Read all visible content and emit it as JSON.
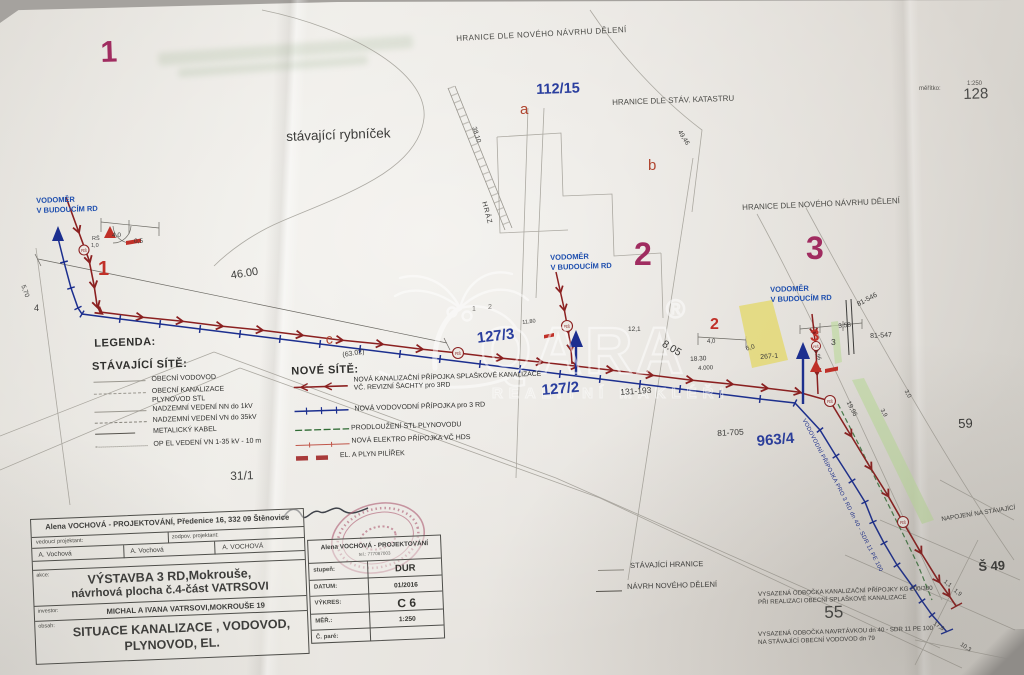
{
  "watermark": {
    "brand": "QARA",
    "reg": "®",
    "subtitle": "REALITNÍ MAKLÉŘI"
  },
  "scalebar": {
    "label": "měřítko:",
    "value": "1:250"
  },
  "boundaries": {
    "new_top": "HRANICE DLE NOVÉHO NÁVRHU DĚLENÍ",
    "cadastre": "HRANICE DLE STÁV. KATASTRU",
    "new_right": "HRANICE DLE NOVÉHO NÁVRHU DĚLENÍ"
  },
  "features": {
    "pond": "stávající rybníček",
    "dam": "HRÁZ",
    "connect": "NAPOJENÍ NA STÁVAJÍCÍ"
  },
  "areas": {
    "n1": "1",
    "n2": "2",
    "n3": "3",
    "r1": "1",
    "r2": "2",
    "r3": "3",
    "a": "a",
    "b": "b",
    "c": "c",
    "lot1": "1",
    "lot2": "2"
  },
  "parcels": {
    "p11215": "112/15",
    "p1273": "127/3",
    "p1272": "127/2",
    "p9634": "963/4",
    "p311": "31/1",
    "p128": "128",
    "p59": "59",
    "p55": "55",
    "p131": "131-193",
    "p81705": "81-705",
    "p81546": "81-546",
    "p81547": "81-547",
    "p2671": "267-1",
    "s49": "Š 49",
    "p3": "3"
  },
  "water_meter": {
    "l1": "VODOMĚR",
    "l2": "V BUDOUCÍM RD"
  },
  "symbols": {
    "rs": "RŠ",
    "rs_val": "1,0"
  },
  "dims": {
    "d46": "46.00",
    "d6302": "(63.02)",
    "d570": "5,70",
    "d4": "4",
    "d40": "4,0",
    "d05": "0,5",
    "d3810": "38,10",
    "d4946": "49,46",
    "d1180": "11,80",
    "d121": "12,1",
    "d805": "8.05",
    "d1830": "18.30",
    "d4000": "4.000",
    "d40b": "4,0",
    "d358": "3,58",
    "d60": "6,0",
    "d196": "1,96",
    "d1996": "19,96",
    "d30": "3,0",
    "d39": "3,9",
    "d11": "1,1",
    "d19": "1,9",
    "d178": "17,8",
    "d103": "10,3"
  },
  "pipes": {
    "water_branch": "VODOVODNÍ PŘÍPOJKA PRO 3 RD dn 40 - SDR 11 PE 100"
  },
  "legend": {
    "title": "LEGENDA:",
    "existing_title": "STÁVAJÍCÍ SÍTĚ:",
    "existing": [
      "OBECNÍ VODOVOD",
      "OBECNÍ KANALIZACE",
      "PLYNOVOD STL",
      "NADZEMNÍ VEDENÍ  NN do 1kV",
      "NADZEMNÍ VEDENÍ  VN do 35kV",
      "METALICKÝ KABEL",
      "OP EL VEDENÍ VN 1-35 kV  - 10 m"
    ],
    "new_title": "NOVÉ SÍTĚ:",
    "new_1a": "NOVÁ KANALIZAČNÍ PŘÍPOJKA SPLAŠKOVÉ KANALIZACE",
    "new_1b": "VČ. REVIZNÍ  ŠACHTY  pro 3RD",
    "new_2": "NOVÁ VODOVODNÍ  PŘÍPOJKA  pro 3 RD",
    "new_3": "PRODLOUŽENÍ  STL  PLYNOVODU",
    "new_4": "NOVÁ ELEKTRO  PŘÍPOJKA VČ HDS",
    "new_5": "EL. A PLYN PILÍŘEK"
  },
  "mini_legend": {
    "existing": "STÁVAJÍCÍ  HRANICE",
    "new": "NÁVRH NOVÉHO DĚLENÍ"
  },
  "notes": {
    "sewer1": "VYSAZENÁ ODBOČKA  KANALIZAČNÍ PŘÍPOJKY  KG 200/300",
    "sewer2": "PŘI REALIZACI OBECNÍ SPLAŠKOVÉ KANALIZACE",
    "water1": "VYSAZENÁ ODBOČKA  NAVRTÁVKOU dn 40  - SDR 11 PE 100",
    "water2": "NA STÁVAJÍCÍ OBECNÍ VODOVOD  dn 79"
  },
  "title_block": {
    "company": "Alena VOCHOVÁ - PROJEKTOVÁNÍ, Předenice 16, 332 09 Štěnovice",
    "lead_label": "vedoucí projektant:",
    "resp_label": "zodpov. projektant:",
    "name1": "A. Vochová",
    "name2": "A. Vochová",
    "name3": "A. VOCHOVÁ",
    "akce_label": "akce:",
    "akce1": "VÝSTAVBA 3 RD,Mokrouše,",
    "akce2": "návrhová plocha č.4-část VATRSOVI",
    "investor_label": "investor:",
    "investor": "MICHAL A IVANA VATRSOVI,MOKROUŠE 19",
    "obsah_label": "obsah:",
    "obsah1": "SITUACE  KANALIZACE , VODOVOD,",
    "obsah2": "PLYNOVOD, EL.",
    "company_short": "Alena VOCHOVÁ - PROJEKTOVÁNÍ",
    "phone": "tel.: 777087003",
    "stupen_label": "stupeň:",
    "stupen": "DUR",
    "datum_label": "DATUM:",
    "datum": "01/2016",
    "vykres_label": "VÝKRES:",
    "vykres": "C 6",
    "mer_label": "MĚŘ.:",
    "mer": "1:250",
    "pare_label": "Č. paré:"
  }
}
